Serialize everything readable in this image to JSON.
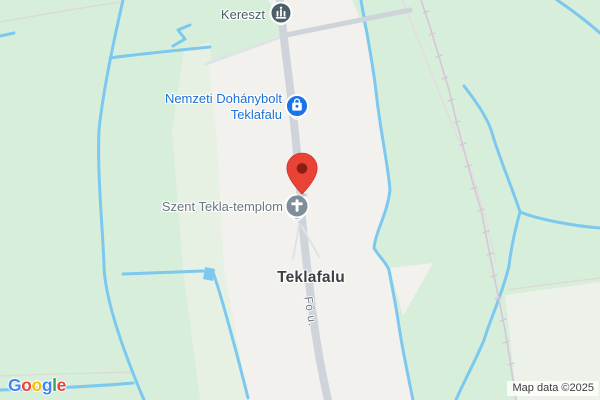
{
  "map_labels": {
    "kereszt": {
      "text": "Kereszt",
      "color": "#4b5a63"
    },
    "shop": {
      "line1": "Nemzeti Dohánybolt",
      "line2": "Teklafalu",
      "color": "#1d70d2"
    },
    "church": {
      "text": "Szent Tekla-templom",
      "color": "#6b757e"
    },
    "town": {
      "text": "Teklafalu",
      "color": "#3c4043"
    },
    "road": {
      "text": "Fő u.",
      "color": "#6f777e"
    }
  },
  "icons": {
    "monument": {
      "name": "monument-icon",
      "color": "#4e5f69"
    },
    "shopping_bag": {
      "name": "shopping-bag-icon",
      "color": "#1a73e8"
    },
    "church_cross": {
      "name": "cross-icon",
      "color": "#7e8f9b"
    },
    "marker": {
      "name": "map-pin-icon",
      "color": "#EA4335",
      "inner": "#8c1d12"
    }
  },
  "colors": {
    "land_green": "#d7eeda",
    "pale_green_strip": "#e6f1e3",
    "pale_corner": "#ecf1ea",
    "built_area": "#f2f1ed",
    "water": "#7cc8ef",
    "road": "#ced4da",
    "minor_road": "#dfe3e6",
    "railway": "#d8c5d8",
    "faint_rail": "#e4d9e3",
    "faint_line": "#ddd9d3"
  },
  "branding": {
    "google_letters": [
      {
        "ch": "G",
        "color": "#4285F4"
      },
      {
        "ch": "o",
        "color": "#EA4335"
      },
      {
        "ch": "o",
        "color": "#FBBC05"
      },
      {
        "ch": "g",
        "color": "#4285F4"
      },
      {
        "ch": "l",
        "color": "#34A853"
      },
      {
        "ch": "e",
        "color": "#EA4335"
      }
    ]
  },
  "attribution": {
    "text": "Map data ©2025",
    "color": "#3b3b3b"
  }
}
